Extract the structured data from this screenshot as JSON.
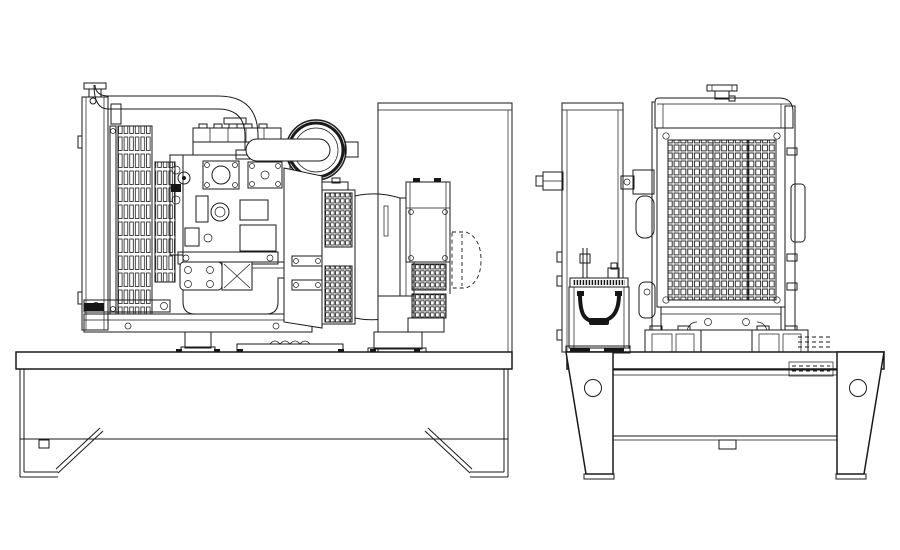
{
  "page": {
    "background": "#ffffff"
  },
  "drawing": {
    "type": "technical-line-drawing",
    "subject": "Open-frame diesel generator set, two orthographic views",
    "style": "monochrome CAD outline drawing",
    "line_color": "#1a1a1a",
    "dark_fill": "#161616",
    "views": [
      {
        "id": "side",
        "label": "Side elevation: radiator, engine, air cleaner, alternator and terminal box on base skid"
      },
      {
        "id": "end",
        "label": "End elevation: control panel stand, battery, radiator guard grille and base legs"
      }
    ],
    "components": {
      "radiator_side": "Radiator with louvered side core",
      "radiator_cap": "Radiator filler cap",
      "coolant_hose": "Upper coolant hose with elbow",
      "engine": "Diesel engine block",
      "valve_cover": "Valve cover",
      "intake_plate": "Intake manifold plate",
      "air_cleaner": "Air cleaner canister",
      "starter": "Starter motor",
      "flywheel_housing": "Flywheel housing",
      "alternator": "Alternator with mesh vent bands",
      "terminal_box": "Terminal box with louvered vents",
      "fan_cowl": "Hidden discharge cowl (dashed outline)",
      "rear_panel": "Rear mounting plate",
      "base_skid_side": "Base skid with end legs and diagonal braces",
      "panel_stand": "Control panel stand",
      "battery": "Starting battery with carry strap",
      "battery_tray": "Battery tray with hatched pad",
      "radiator_front": "Radiator front tank and guard grille",
      "grille": "Protective mesh grille",
      "base_legs_end": "Trapezoid base legs with lifting holes"
    },
    "grille": {
      "columns": 16,
      "rows": 21
    },
    "louvers": {
      "radiator_slat_columns": 9,
      "alternator_vent_bands": 2,
      "terminal_box_vent_bands": 2
    },
    "legs": {
      "end_view_hole_count": 2
    }
  }
}
